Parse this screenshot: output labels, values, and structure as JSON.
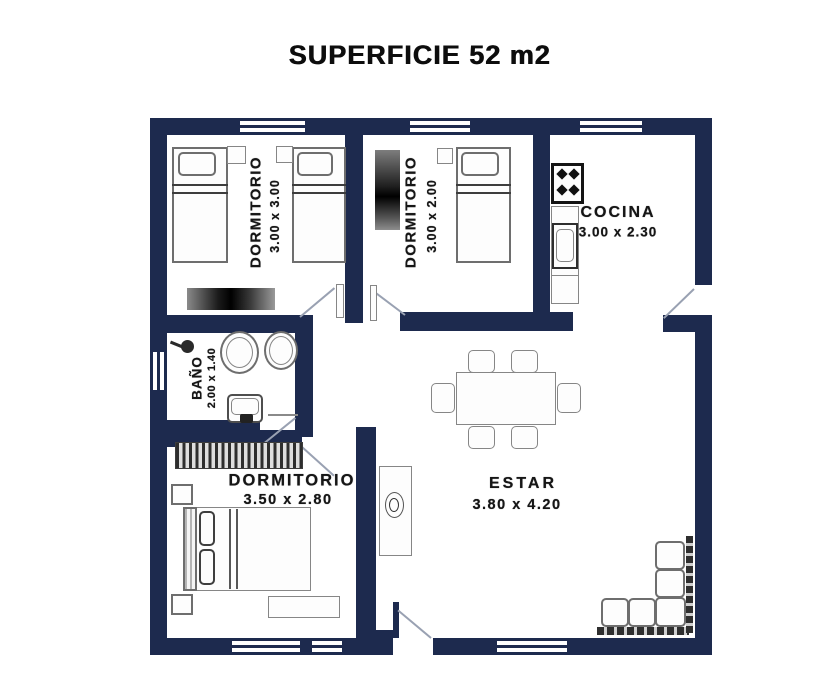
{
  "title": "SUPERFICIE 52 m2",
  "rooms": {
    "dormitorio_1": {
      "name": "DORMITORIO",
      "dimensions": "3.00 x 3.00"
    },
    "dormitorio_2": {
      "name": "DORMITORIO",
      "dimensions": "3.00 x 2.00"
    },
    "cocina": {
      "name": "COCINA",
      "dimensions": "3.00 x 2.30"
    },
    "bano": {
      "name": "BAÑO",
      "dimensions": "2.00 x 1.40"
    },
    "dormitorio_3": {
      "name": "DORMITORIO",
      "dimensions": "3.50 x 2.80"
    },
    "estar": {
      "name": "ESTAR",
      "dimensions": "3.80 x 4.20"
    }
  },
  "colors": {
    "wall": "#1d2a4e",
    "text": "#161616",
    "background": "#ffffff"
  }
}
